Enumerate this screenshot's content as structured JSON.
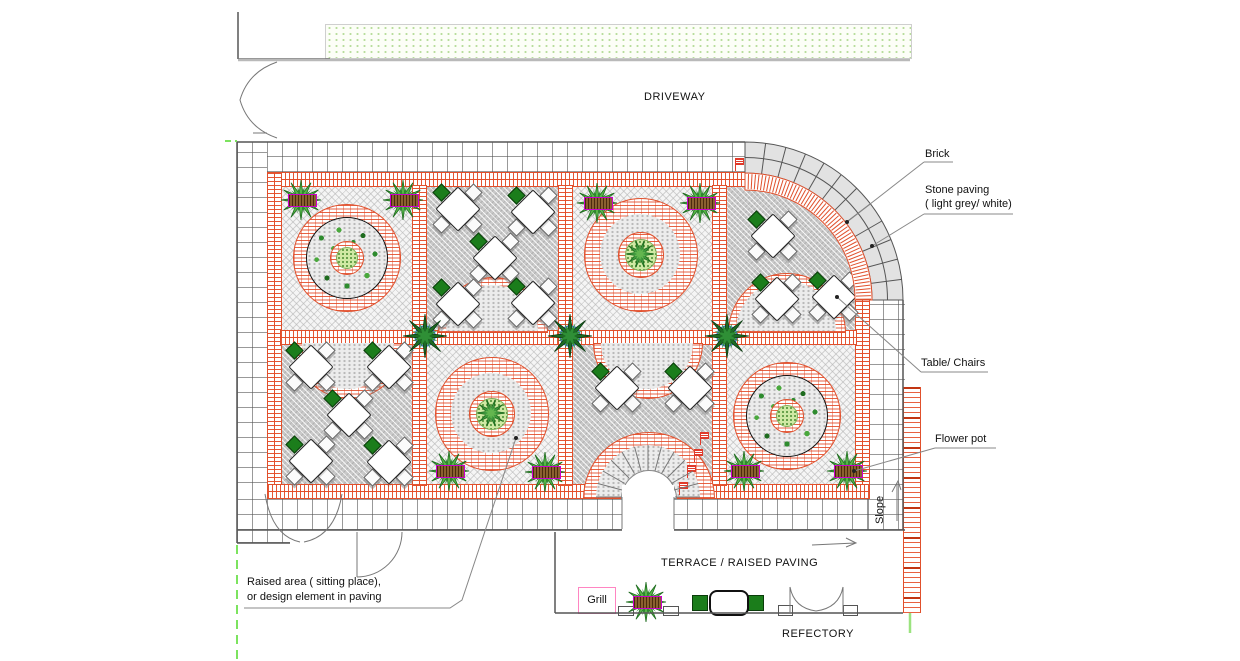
{
  "labels": {
    "driveway": "DRIVEWAY",
    "brick": "Brick",
    "stone_paving_1": "Stone paving",
    "stone_paving_2": "( light grey/ white)",
    "table_chairs": "Table/ Chairs",
    "flower_pot": "Flower pot",
    "slope": "Slope",
    "terrace": "TERRACE / RAISED PAVING",
    "grill": "Grill",
    "refectory": "REFECTORY",
    "raised_area_1": "Raised area ( sitting place),",
    "raised_area_2": "or design element in paving"
  },
  "colors": {
    "brick_red": "#e0502c",
    "stone_grey": "#e2e2e2",
    "panel_dark_grey": "#c9c9c9",
    "panel_light": "#f5f5f5",
    "plant_dark_green": "#1d6b24",
    "plant_light_green": "#cfe9a4",
    "pot_magenta": "#cc00cc",
    "grill_pink": "#ff85c2",
    "boundary_green": "#7ce35f"
  },
  "plan": {
    "tables": [
      {
        "x": 457,
        "y": 208
      },
      {
        "x": 532,
        "y": 211
      },
      {
        "x": 494,
        "y": 257
      },
      {
        "x": 457,
        "y": 303
      },
      {
        "x": 532,
        "y": 302
      },
      {
        "x": 772,
        "y": 235
      },
      {
        "x": 776,
        "y": 298
      },
      {
        "x": 833,
        "y": 296
      },
      {
        "x": 310,
        "y": 366
      },
      {
        "x": 388,
        "y": 366
      },
      {
        "x": 348,
        "y": 414
      },
      {
        "x": 310,
        "y": 460
      },
      {
        "x": 388,
        "y": 461
      },
      {
        "x": 616,
        "y": 387
      },
      {
        "x": 689,
        "y": 387
      }
    ],
    "terrace_table": {
      "x": 727,
      "y": 601
    },
    "flower_pots": [
      {
        "x": 301,
        "y": 200
      },
      {
        "x": 403,
        "y": 200
      },
      {
        "x": 597,
        "y": 203
      },
      {
        "x": 700,
        "y": 203
      },
      {
        "x": 449,
        "y": 471
      },
      {
        "x": 545,
        "y": 472
      },
      {
        "x": 744,
        "y": 471
      },
      {
        "x": 847,
        "y": 471
      },
      {
        "x": 646,
        "y": 602
      }
    ],
    "intersection_plants": [
      {
        "x": 425,
        "y": 336
      },
      {
        "x": 570,
        "y": 336
      },
      {
        "x": 727,
        "y": 336
      }
    ],
    "circle_motifs": [
      {
        "cx": 346,
        "cy": 257,
        "style": "planted"
      },
      {
        "cx": 640,
        "cy": 254,
        "style": "ringed"
      },
      {
        "cx": 491,
        "cy": 413,
        "style": "ringed"
      },
      {
        "cx": 786,
        "cy": 415,
        "style": "planted"
      }
    ],
    "half_discs": [
      {
        "x": 492,
        "y": 331,
        "r": 54,
        "dir": "up"
      },
      {
        "x": 786,
        "y": 331,
        "r": 58,
        "dir": "up"
      },
      {
        "x": 348,
        "y": 343,
        "r": 54,
        "dir": "down"
      },
      {
        "x": 647,
        "y": 343,
        "r": 54,
        "dir": "down"
      }
    ],
    "arch": {
      "cx": 648,
      "cy": 497
    },
    "dimension_markers": [
      {
        "x": 757,
        "y": 151
      },
      {
        "x": 806,
        "y": 166
      },
      {
        "x": 822,
        "y": 181
      },
      {
        "x": 838,
        "y": 198
      },
      {
        "x": 851,
        "y": 215
      },
      {
        "x": 700,
        "y": 432
      },
      {
        "x": 694,
        "y": 449
      },
      {
        "x": 687,
        "y": 465
      },
      {
        "x": 679,
        "y": 482
      },
      {
        "x": 735,
        "y": 158
      }
    ]
  }
}
